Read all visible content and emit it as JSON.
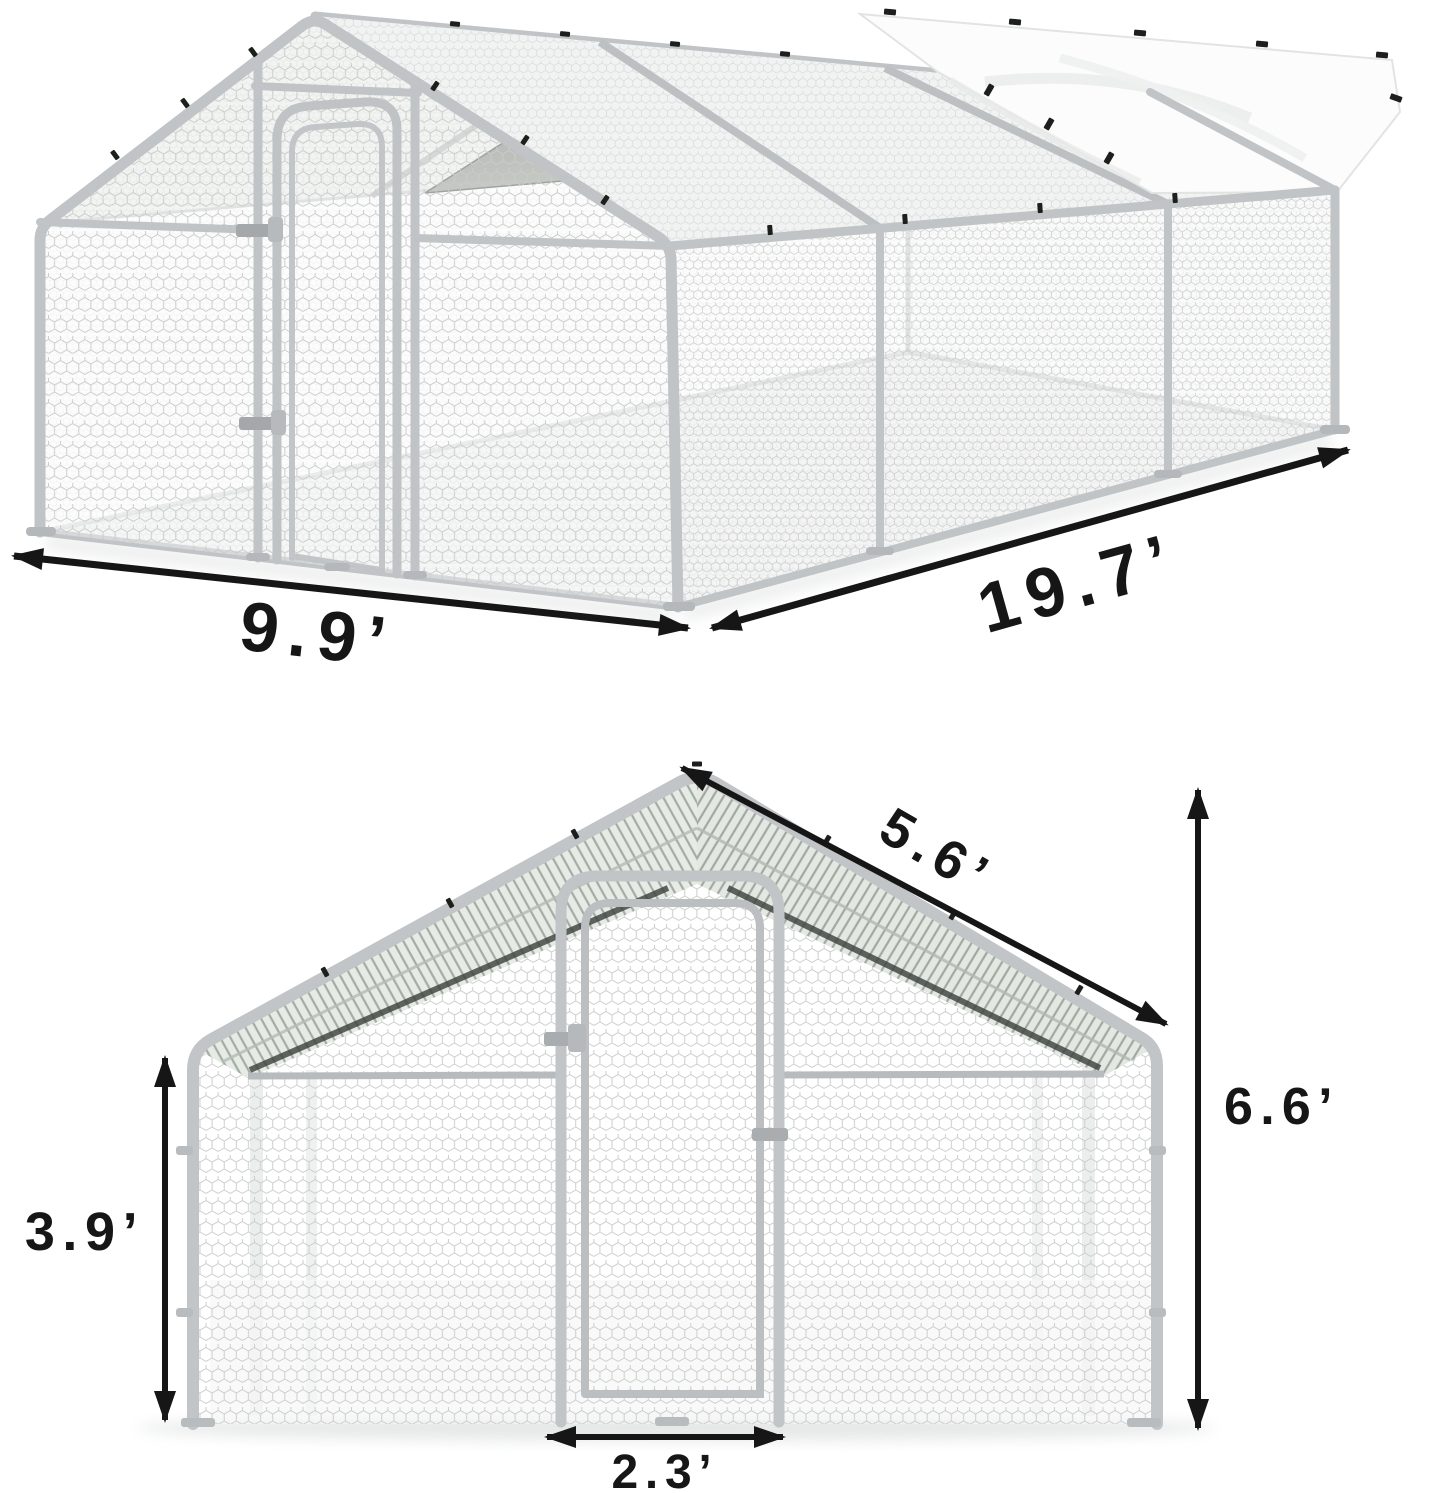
{
  "product_view": {
    "type": "product-dimension-diagram",
    "views": [
      {
        "id": "perspective",
        "description": "walk-in metal chicken run, perspective view, hex wire mesh, partial white tarp roof cover and dark shade cloth"
      },
      {
        "id": "front",
        "description": "front elevation of gable end with walk-in door"
      }
    ]
  },
  "dims": {
    "width": "9.9’",
    "length": "19.7’",
    "slope": "5.6’",
    "height": "6.6’",
    "wall": "3.9’",
    "door": "2.3’"
  },
  "colors": {
    "dimension_ink": "#161616",
    "frame_metal": "#c1c4c6",
    "mesh_line": "#c9ccca",
    "tarp_white": "#fcfcfc",
    "tarp_shade_dark": "#868a84",
    "background": "#ffffff"
  }
}
